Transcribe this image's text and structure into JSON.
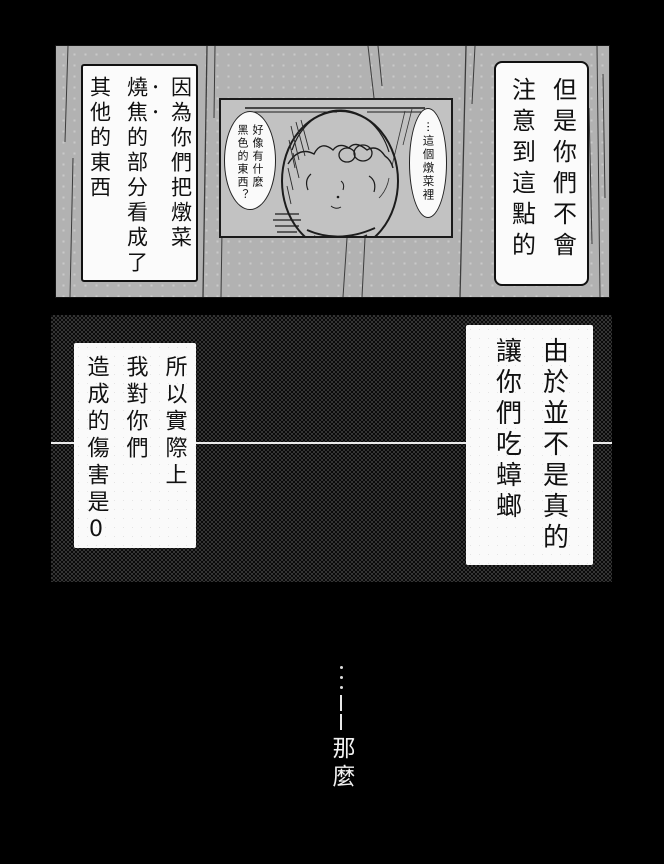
{
  "page": {
    "type": "manga-page"
  },
  "colors": {
    "page_bg": "#000000",
    "top_panel_gray": "#b2b2b2",
    "inset_gray": "#c2c2c2",
    "box_white": "#fafafa",
    "text_black": "#111111",
    "text_white": "#f2f2f2",
    "mid_panel_dither": "#343434"
  },
  "top_panel": {
    "right_box": {
      "lines": [
        "但是你們不會",
        "注意到這點的"
      ]
    },
    "left_box": {
      "line1": "因為你們把燉菜",
      "line2_em": "燒焦",
      "line2_rest": "的部分看成了",
      "line3": "其他的東西"
    },
    "inset": {
      "left_bubble": {
        "lines": [
          "好像有什麼",
          "黑色的東西？"
        ]
      },
      "right_bubble": {
        "lines": [
          "⋯這個燉菜裡"
        ]
      },
      "illustration": "pot-of-stew"
    }
  },
  "middle_panel": {
    "right_box": {
      "lines": [
        "由於並不是真的",
        "讓你們吃蟑螂"
      ]
    },
    "left_box": {
      "lines": [
        "所以實際上",
        "我對你們",
        "造成的傷害是0"
      ]
    }
  },
  "bottom": {
    "ellipsis": "……",
    "dash": "——",
    "text": "那麼"
  }
}
